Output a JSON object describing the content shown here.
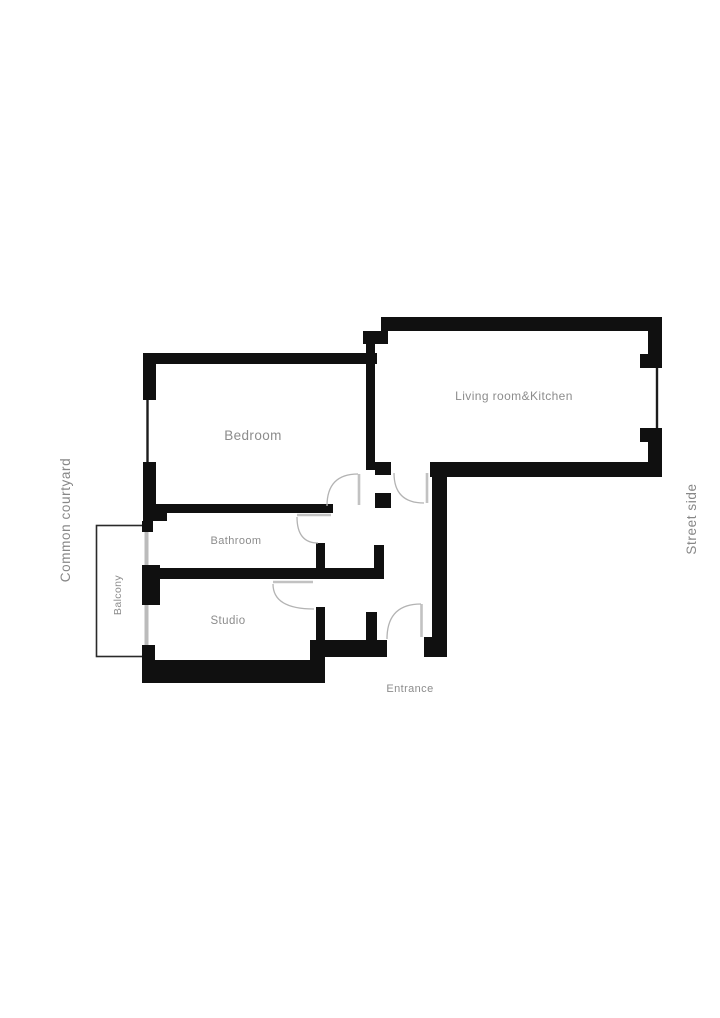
{
  "plan": {
    "rooms": {
      "bedroom": {
        "label": "Bedroom"
      },
      "living": {
        "label": "Living room&Kitchen"
      },
      "bathroom": {
        "label": "Bathroom"
      },
      "studio": {
        "label": "Studio"
      },
      "balcony": {
        "label": "Balcony"
      },
      "entrance": {
        "label": "Entrance"
      }
    },
    "orientation": {
      "left": {
        "label": "Common courtyard"
      },
      "right": {
        "label": "Street side"
      }
    },
    "colors": {
      "wall": "#101010",
      "label_text": "#8c8c8c",
      "window_line": "#1c1c1c",
      "balcony_window_line": "#bbbbbb",
      "door_arc": "#b3b3b3",
      "background": "#ffffff"
    }
  }
}
